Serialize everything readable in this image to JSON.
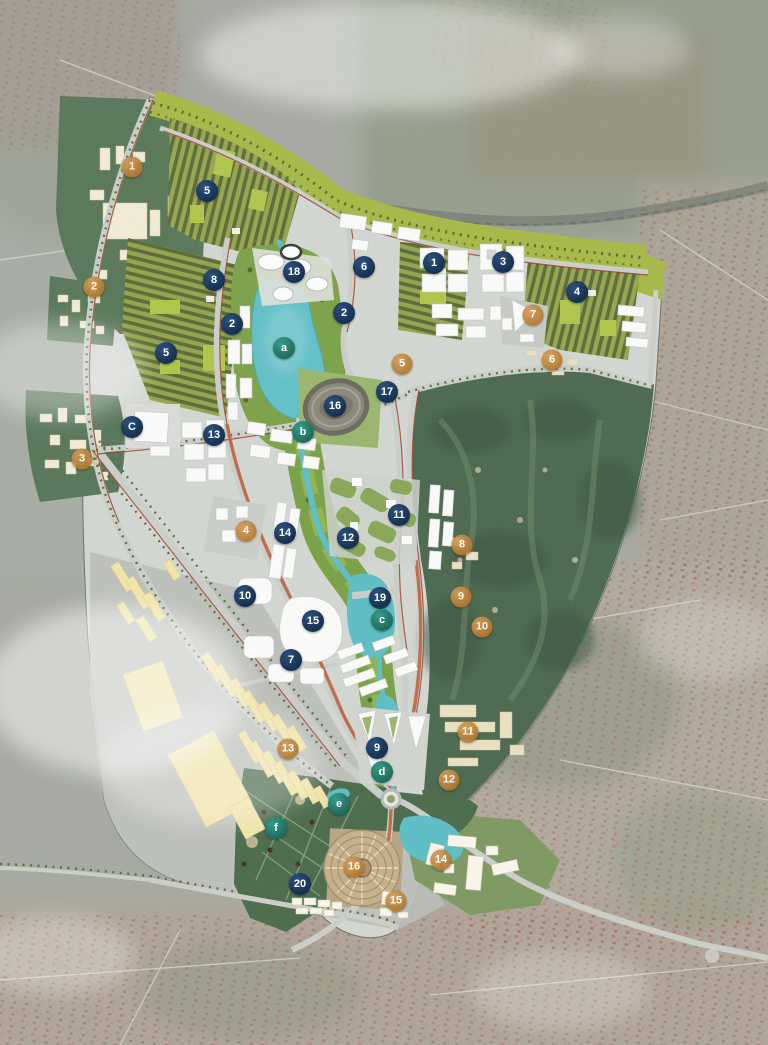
{
  "meta": {
    "title": "Urban masterplan aerial rendering",
    "canvas_width": 768,
    "canvas_height": 1045
  },
  "palette": {
    "marker_navy": "#16304f",
    "marker_bronze": "#b0762f",
    "marker_teal": "#1d6a5c",
    "site_gray": "#d7dad6",
    "park_dark_green": "#5b7a5b",
    "golf_green": "#4e6b51",
    "water_teal": "#5fc0c8",
    "green_belt": "#a9bb4a",
    "industrial_yellow": "#f4e7ab",
    "satellite_gray": "#a8aca4",
    "roof_red": "#a97a68"
  },
  "markers": {
    "navy_numbered": [
      {
        "label": "1",
        "x": 434,
        "y": 263
      },
      {
        "label": "2",
        "x": 344,
        "y": 313
      },
      {
        "label": "2",
        "x": 232,
        "y": 324
      },
      {
        "label": "3",
        "x": 503,
        "y": 262
      },
      {
        "label": "4",
        "x": 577,
        "y": 292
      },
      {
        "label": "5",
        "x": 207,
        "y": 191
      },
      {
        "label": "5",
        "x": 166,
        "y": 353
      },
      {
        "label": "6",
        "x": 364,
        "y": 267
      },
      {
        "label": "7",
        "x": 291,
        "y": 660
      },
      {
        "label": "8",
        "x": 214,
        "y": 280
      },
      {
        "label": "9",
        "x": 377,
        "y": 748
      },
      {
        "label": "10",
        "x": 245,
        "y": 596
      },
      {
        "label": "11",
        "x": 399,
        "y": 515
      },
      {
        "label": "12",
        "x": 348,
        "y": 538
      },
      {
        "label": "13",
        "x": 214,
        "y": 435
      },
      {
        "label": "14",
        "x": 285,
        "y": 533
      },
      {
        "label": "15",
        "x": 313,
        "y": 621
      },
      {
        "label": "16",
        "x": 335,
        "y": 406
      },
      {
        "label": "17",
        "x": 387,
        "y": 392
      },
      {
        "label": "18",
        "x": 294,
        "y": 272
      },
      {
        "label": "19",
        "x": 380,
        "y": 598
      },
      {
        "label": "20",
        "x": 300,
        "y": 884
      }
    ],
    "bronze_numbered": [
      {
        "label": "1",
        "x": 132,
        "y": 167
      },
      {
        "label": "2",
        "x": 94,
        "y": 287
      },
      {
        "label": "3",
        "x": 82,
        "y": 459
      },
      {
        "label": "4",
        "x": 246,
        "y": 531
      },
      {
        "label": "5",
        "x": 402,
        "y": 364
      },
      {
        "label": "6",
        "x": 552,
        "y": 360
      },
      {
        "label": "7",
        "x": 533,
        "y": 315
      },
      {
        "label": "8",
        "x": 462,
        "y": 545
      },
      {
        "label": "9",
        "x": 461,
        "y": 597
      },
      {
        "label": "10",
        "x": 482,
        "y": 627
      },
      {
        "label": "11",
        "x": 468,
        "y": 732
      },
      {
        "label": "12",
        "x": 449,
        "y": 780
      },
      {
        "label": "13",
        "x": 288,
        "y": 749
      },
      {
        "label": "14",
        "x": 441,
        "y": 860
      },
      {
        "label": "15",
        "x": 396,
        "y": 901
      },
      {
        "label": "16",
        "x": 354,
        "y": 867
      }
    ],
    "teal_lettered": [
      {
        "label": "a",
        "x": 284,
        "y": 348
      },
      {
        "label": "b",
        "x": 303,
        "y": 432
      },
      {
        "label": "c",
        "x": 382,
        "y": 620
      },
      {
        "label": "d",
        "x": 382,
        "y": 772
      },
      {
        "label": "e",
        "x": 339,
        "y": 804
      },
      {
        "label": "f",
        "x": 276,
        "y": 828
      }
    ],
    "navy_lettered": [
      {
        "label": "C",
        "x": 132,
        "y": 427
      }
    ]
  }
}
